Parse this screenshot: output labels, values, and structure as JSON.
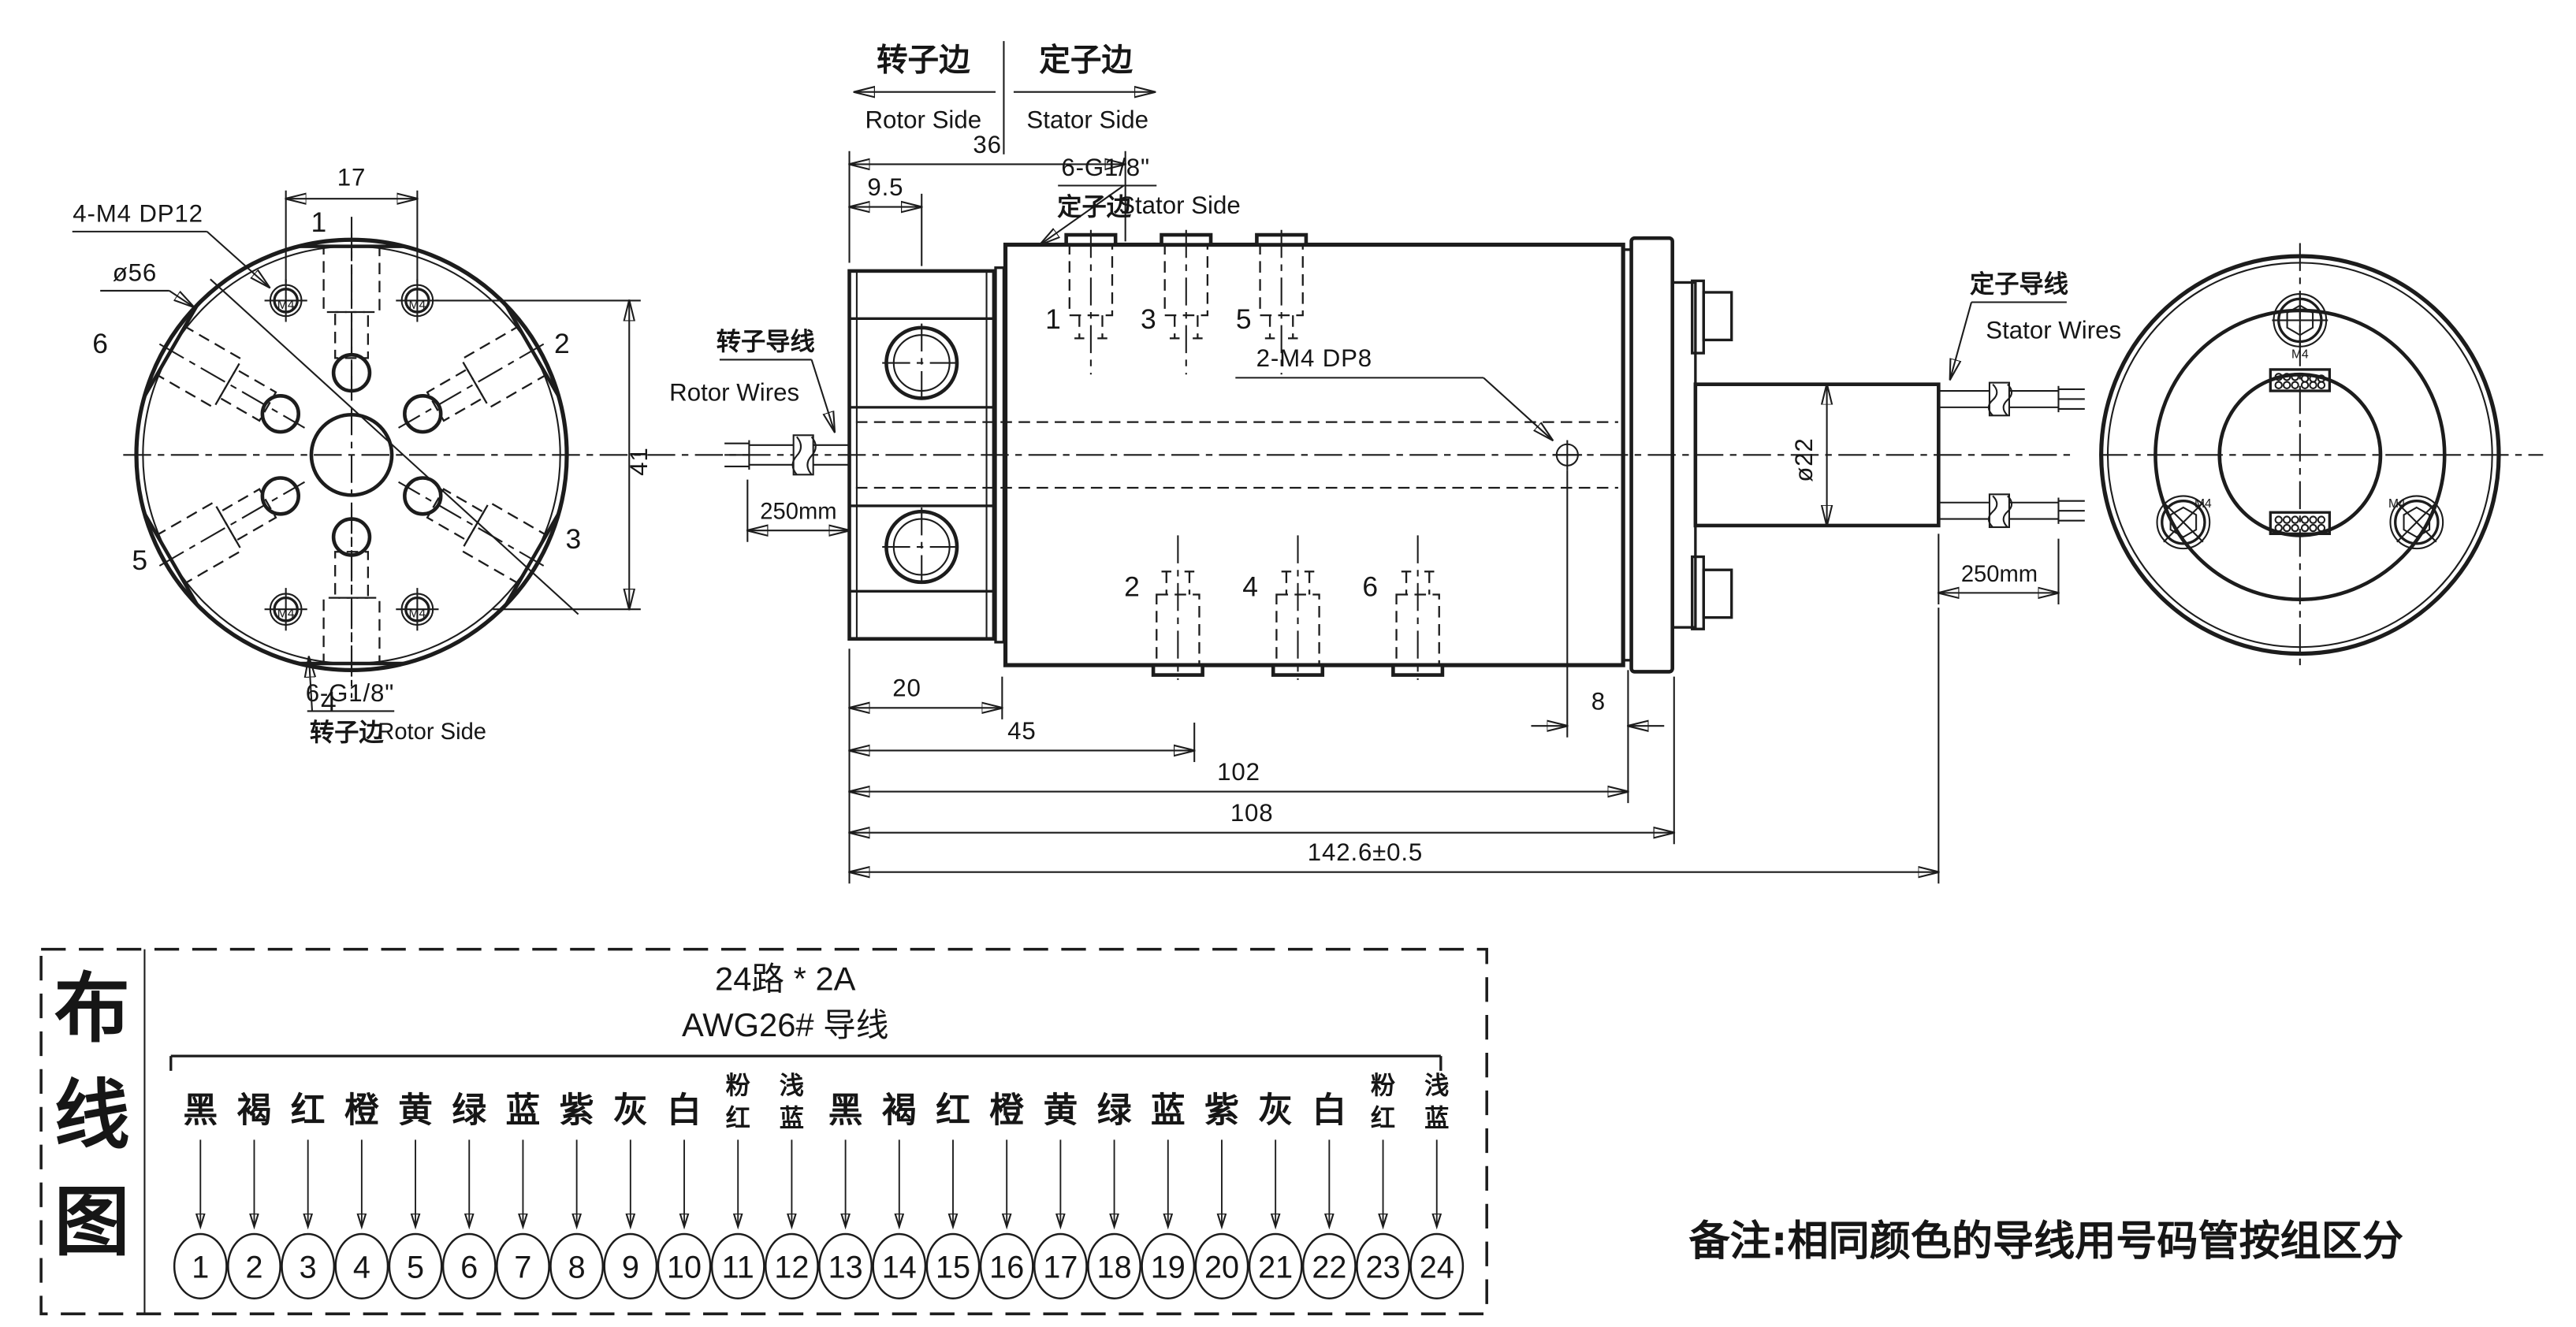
{
  "drawing": {
    "header": {
      "rotor_cn": "转子边",
      "rotor_en": "Rotor Side",
      "stator_cn": "定子边",
      "stator_en": "Stator Side"
    },
    "left_view": {
      "leader_m4": "4-M4 DP12",
      "leader_dia": "ø56",
      "dim_17": "17",
      "dim_41": "41",
      "ports": [
        "1",
        "2",
        "3",
        "4",
        "5",
        "6"
      ],
      "leader_g18": "6-G1/8\"",
      "side_cn": "转子边",
      "side_en": "Rotor Side",
      "m4": "M4"
    },
    "side_view": {
      "dim_36": "36",
      "dim_9_5": "9.5",
      "leader_g18": "6-G1/8\"",
      "g18_side_cn": "定子边",
      "g18_side_en": "Stator Side",
      "top_ports": [
        "1",
        "3",
        "5"
      ],
      "bottom_ports": [
        "2",
        "4",
        "6"
      ],
      "leader_m4": "2-M4 DP8",
      "rotor_wires_cn": "转子导线",
      "rotor_wires_en": "Rotor Wires",
      "len_left": "250mm",
      "stator_wires_cn": "定子导线",
      "stator_wires_en": "Stator Wires",
      "len_right": "250mm",
      "dim_dia22": "ø22",
      "dim_20": "20",
      "dim_45": "45",
      "dim_102": "102",
      "dim_108": "108",
      "dim_8": "8",
      "dim_total": "142.6±0.5"
    },
    "right_view": {
      "m4": "M4"
    }
  },
  "wiring": {
    "panel_title": "布线图",
    "panel_title_chars": [
      "布",
      "线",
      "图"
    ],
    "spec1": "24路 * 2A",
    "spec2": "AWG26# 导线",
    "colors": [
      "黑",
      "褐",
      "红",
      "橙",
      "黄",
      "绿",
      "蓝",
      "紫",
      "灰",
      "白",
      "粉红",
      "浅蓝"
    ],
    "channels": [
      "1",
      "2",
      "3",
      "4",
      "5",
      "6",
      "7",
      "8",
      "9",
      "10",
      "11",
      "12",
      "13",
      "14",
      "15",
      "16",
      "17",
      "18",
      "19",
      "20",
      "21",
      "22",
      "23",
      "24"
    ]
  },
  "note": {
    "text": "备注:相同颜色的导线用号码管按组区分"
  }
}
